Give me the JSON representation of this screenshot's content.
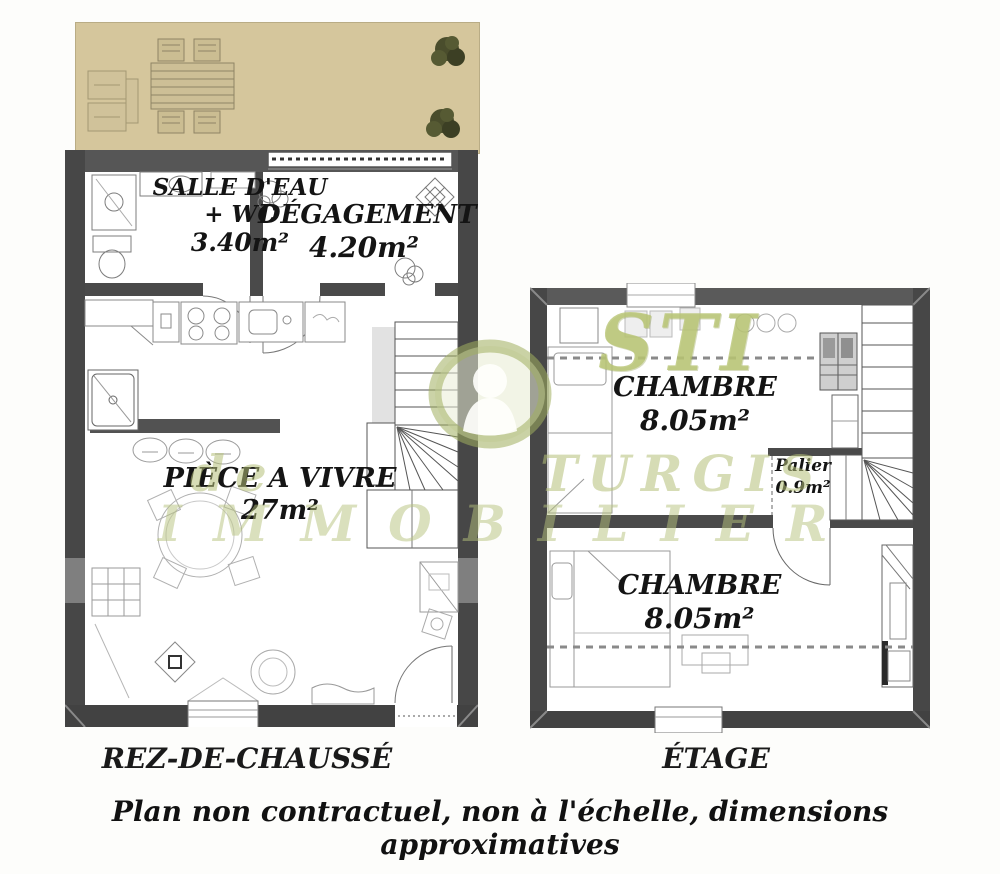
{
  "colors": {
    "terrace_beige": "#d5c69c",
    "wall_gray": "#4a4a4a",
    "wall_light_gray": "#7f7f7f",
    "watermark_green": "#aab873",
    "label_black": "#141414"
  },
  "plans": {
    "ground": {
      "caption": "REZ-DE-CHAUSSÉ",
      "rooms": [
        {
          "name_lines": [
            "SALLE D'EAU",
            "+ WC"
          ],
          "area": "3.40m²"
        },
        {
          "name_lines": [
            "DÉGAGEMENT"
          ],
          "area": "4.20m²"
        },
        {
          "name_lines": [
            "PIÈCE A VIVRE"
          ],
          "area": "27m²"
        }
      ]
    },
    "upper": {
      "caption": "ÉTAGE",
      "rooms": [
        {
          "name_lines": [
            "CHAMBRE"
          ],
          "area": "8.05m²"
        },
        {
          "name_lines": [
            "Palier"
          ],
          "area": "0.9m²"
        },
        {
          "name_lines": [
            "CHAMBRE"
          ],
          "area": "8.05m²"
        }
      ]
    }
  },
  "watermark": {
    "logo_text": "STI",
    "line1": "de TURGIS",
    "line2": "IMMOBILIER"
  },
  "disclaimer": "Plan non contractuel, non à l'échelle, dimensions approximatives"
}
